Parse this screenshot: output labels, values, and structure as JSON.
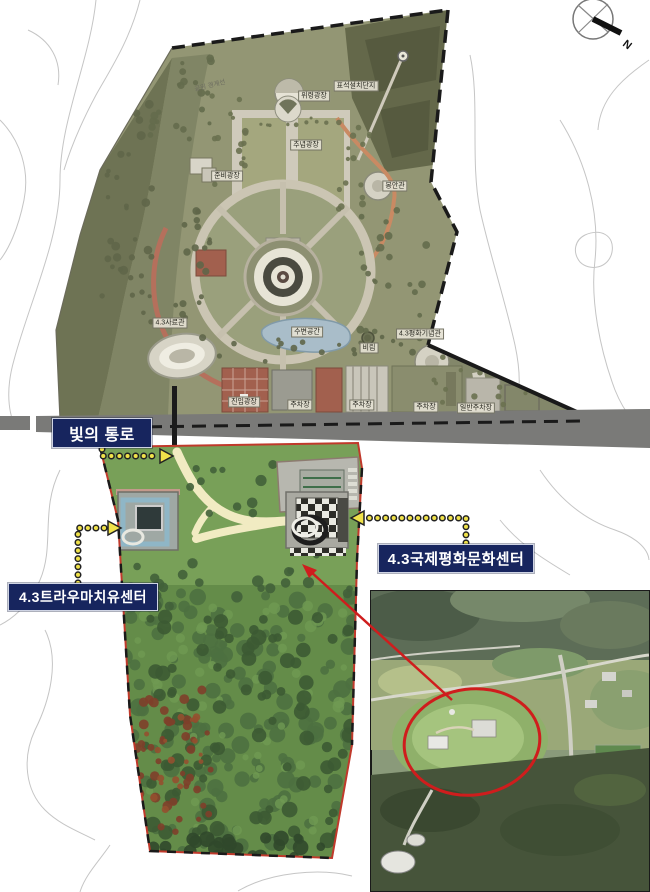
{
  "callouts": {
    "light_corridor": "빛의 통로",
    "culture_center": "4.3국제평화문화센터",
    "trauma_center": "4.3트라우마치유센터"
  },
  "compass": {
    "north_label": "N"
  },
  "facilities": [
    {
      "label": "공원 경계선"
    },
    {
      "label": "표석설치단지"
    },
    {
      "label": "위령광장"
    },
    {
      "label": "추념광장"
    },
    {
      "label": "준비광장"
    },
    {
      "label": "봉안관"
    },
    {
      "label": "4.3사료관"
    },
    {
      "label": "4.3평화기념관"
    },
    {
      "label": "수변공간"
    },
    {
      "label": "비림"
    },
    {
      "label": "진입광장"
    },
    {
      "label": "주차장"
    },
    {
      "label": "주차장"
    },
    {
      "label": "주차장"
    },
    {
      "label": "일반주차장"
    }
  ],
  "colors": {
    "callout_bg": "#17255e",
    "callout_text": "#ffffff",
    "site_boundary_red": "#c0392b",
    "arrow_yellow": "#f0e24a",
    "highlight_red": "#cf1d1d",
    "park_olive": "#939674",
    "lawn_green": "#78a058",
    "forest_green": "#648c49",
    "road_gray": "#7a7a78"
  }
}
